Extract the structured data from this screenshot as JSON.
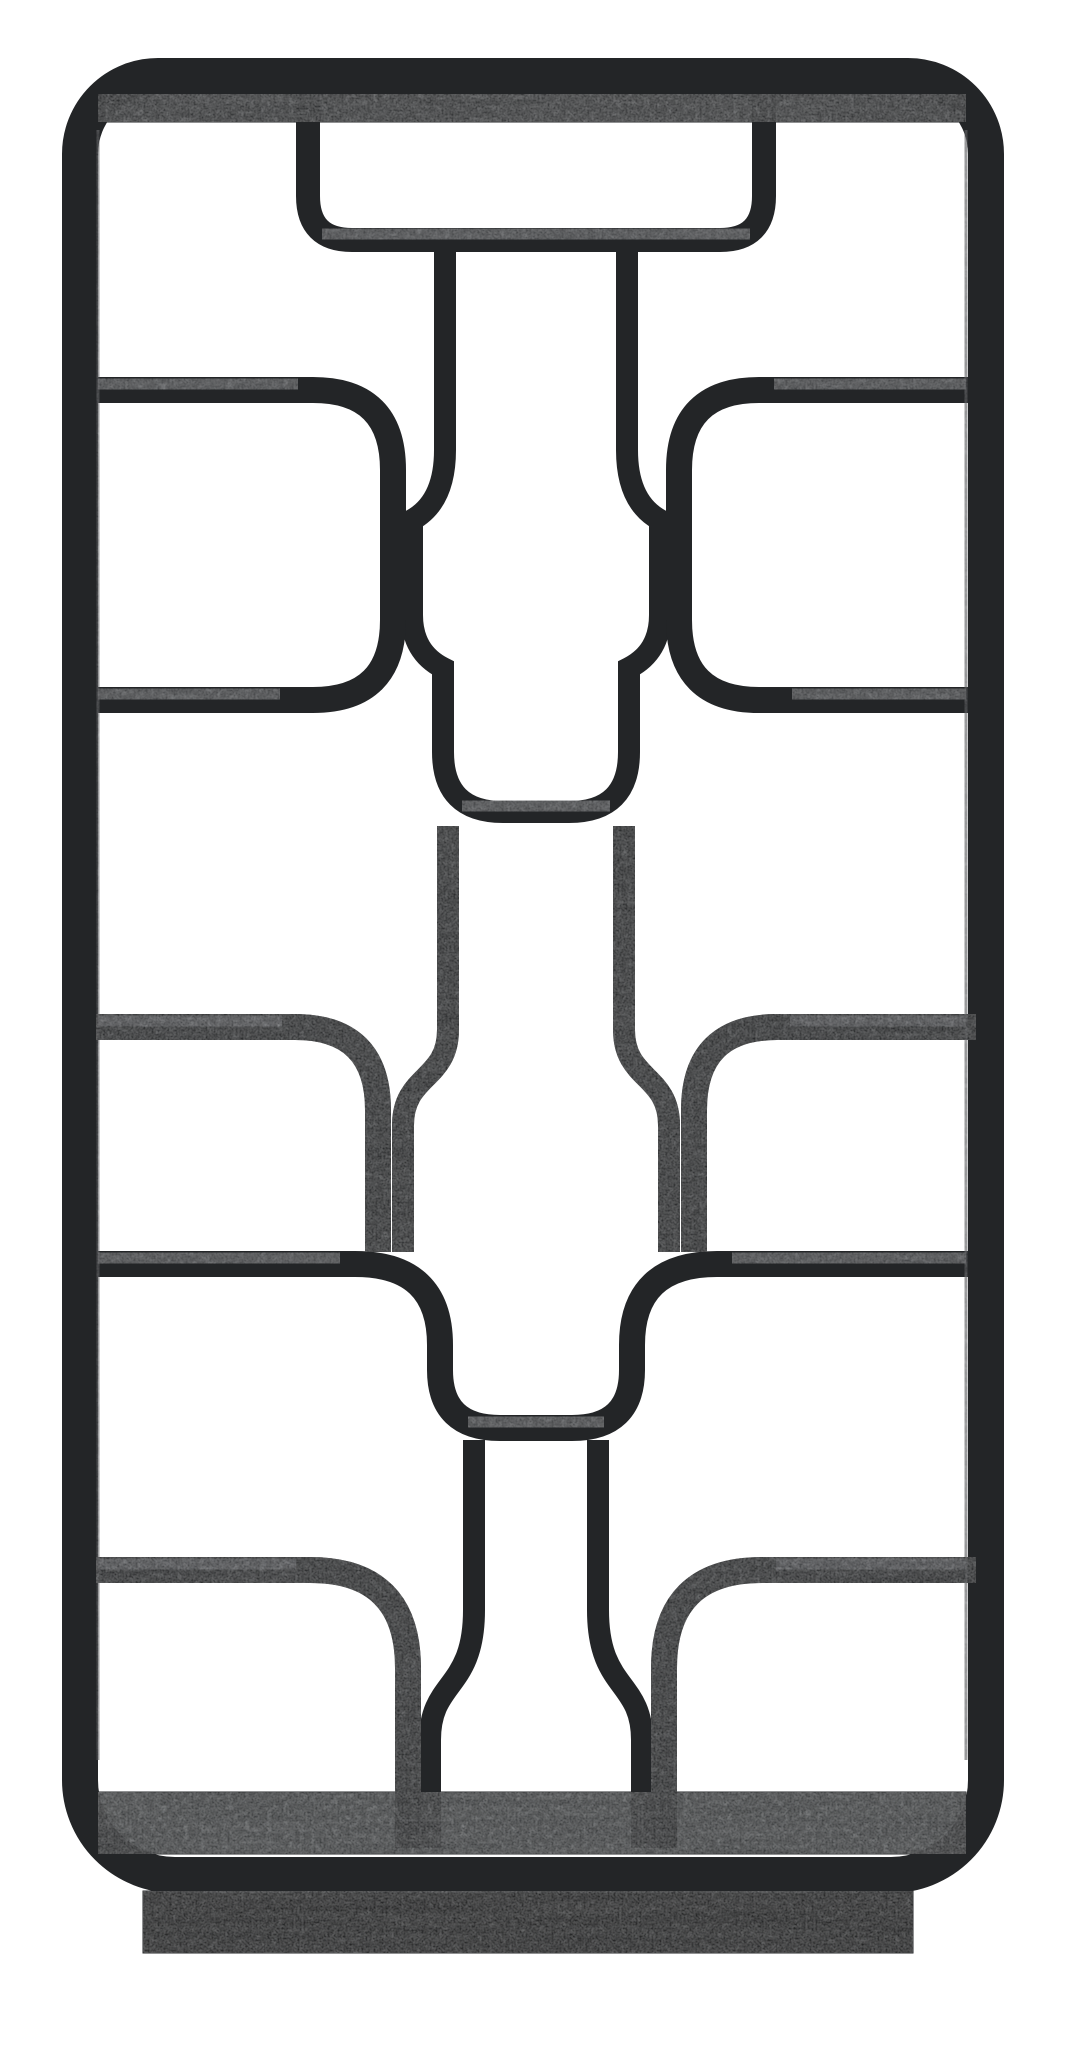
{
  "meta": {
    "title": "Black geometric open shelving unit",
    "caption": "Tall rectangular black mango-wood etagere with rounded corners and an asymmetric lattice of curved open shelf compartments, standing on a recessed plinth base, photographed against a plain white background.",
    "aria_label": "Product photo of a black geometric open bookcase with curved interlocking shelves"
  },
  "product": {
    "type": "open bookcase / room-divider etagere",
    "finish": "charcoal black washed wood",
    "orientation": "front view",
    "compartment_style": "rounded rectangular cutouts with quarter-circle bends and tapering merged uprights",
    "base": "recessed rectangular plinth"
  },
  "palette": {
    "background": "#ffffff",
    "wood_base": "#232527",
    "wood_deep": "#1d1f21",
    "wood_mid": "#2c2e30",
    "wood_top": "#3a3d3f",
    "wood_highlight": "#4d5053",
    "edge_light": "#45484c",
    "plinth": "#121314"
  }
}
